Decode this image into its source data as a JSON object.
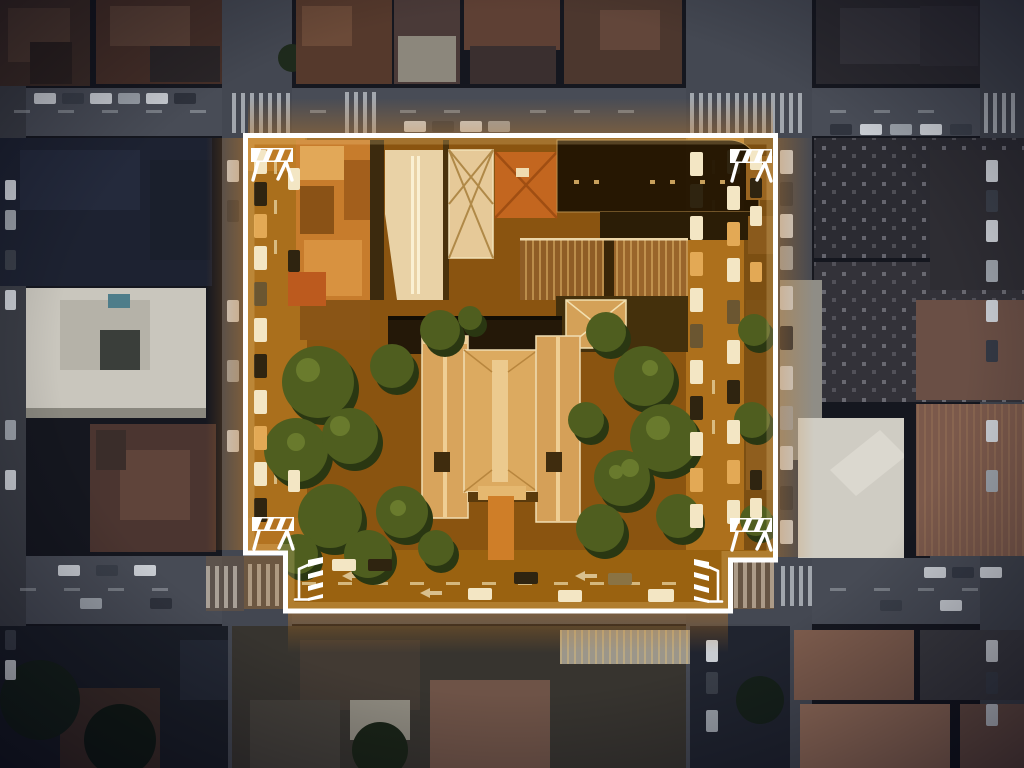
{
  "scene": {
    "type": "aerial-satellite-photo",
    "time_of_day": "night",
    "description": "Top-down night aerial photo of a dense city grid. One full city block is highlighted in warm orange and outlined with a thick white cordon; the rest of the city is darkened. White barricade icons sit at the four corners of the cordon and striped delineator posts mark the two bottom street entrances.",
    "visible_text": []
  },
  "palette": {
    "background": "#111319",
    "street": "#484c56",
    "street_marking": "#b9bec4",
    "highlight_ground": "#9a6212",
    "highlight_street": "#aa6f1c",
    "highlight_glow": "#cd7d1e",
    "border": "#ffffff",
    "tree_canopy": "#4f5e1f",
    "roof_tan": "#d8a45c",
    "roof_dark": "#221502",
    "white_building": "#cfccc3"
  },
  "annotation": {
    "highlight_region": {
      "shape": "polygon",
      "border_color": "#ffffff",
      "border_width": 5,
      "points": [
        [
          245.5,
          135.5
        ],
        [
          775.5,
          135.5
        ],
        [
          775.5,
          560
        ],
        [
          730.5,
          560
        ],
        [
          730.5,
          611
        ],
        [
          285.5,
          611
        ],
        [
          285.5,
          553
        ],
        [
          245.5,
          553
        ]
      ]
    },
    "markers": {
      "barricades": [
        {
          "id": "top-left",
          "x": 250,
          "y": 147
        },
        {
          "id": "top-right",
          "x": 729,
          "y": 148
        },
        {
          "id": "bottom-left",
          "x": 251,
          "y": 516
        },
        {
          "id": "bottom-right",
          "x": 729,
          "y": 517
        }
      ],
      "posts": [
        {
          "id": "bottom-left",
          "x": 294,
          "y": 557,
          "flip": false
        },
        {
          "id": "bottom-right",
          "x": 723,
          "y": 559,
          "flip": true
        }
      ]
    }
  }
}
